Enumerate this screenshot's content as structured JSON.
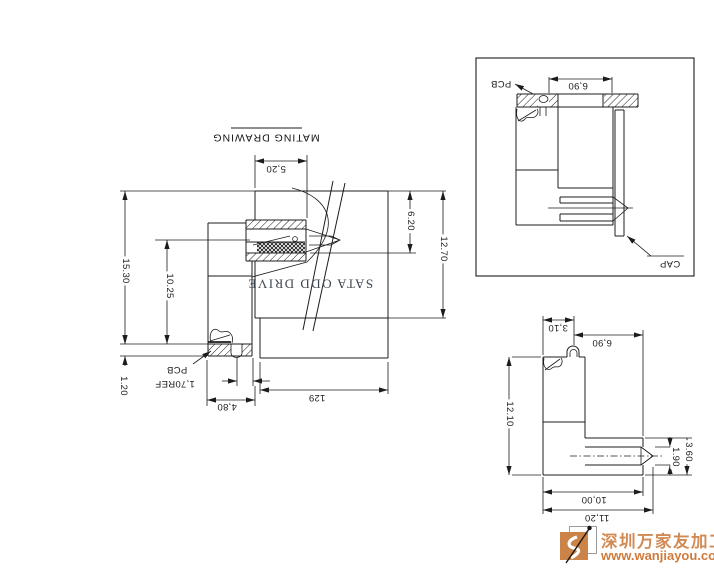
{
  "main_view": {
    "title": "MATING DRAWING",
    "product_label": "SATA ODD DRIVE",
    "pcb_label": "PCB",
    "dims": {
      "width_top": "5,20",
      "height_total": "15.30",
      "height_inner": "10.25",
      "pcb_thickness": "1.20",
      "pin_ref": "1,70REF",
      "housing_width": "4,80",
      "body_width": "129",
      "depth_upper": "6.20",
      "depth_total": "12.70"
    }
  },
  "detail_view": {
    "pcb_label": "PCB",
    "cap_label": "CAP",
    "dims": {
      "boss_width": "6,90"
    }
  },
  "side_view": {
    "dims": {
      "boss_offset": "3,10",
      "tail_width": "6,90",
      "body_height": "12.10",
      "tongue_thickness": "1.90",
      "tail_height": "3.60",
      "body_width": "10,00",
      "overall_width": "11,20"
    }
  },
  "watermark": {
    "company": "深圳万家友加工网",
    "url": "www.wanjiayou.com"
  },
  "colors": {
    "line": "#1c1c1c",
    "accent_orange": "#cc8347"
  }
}
